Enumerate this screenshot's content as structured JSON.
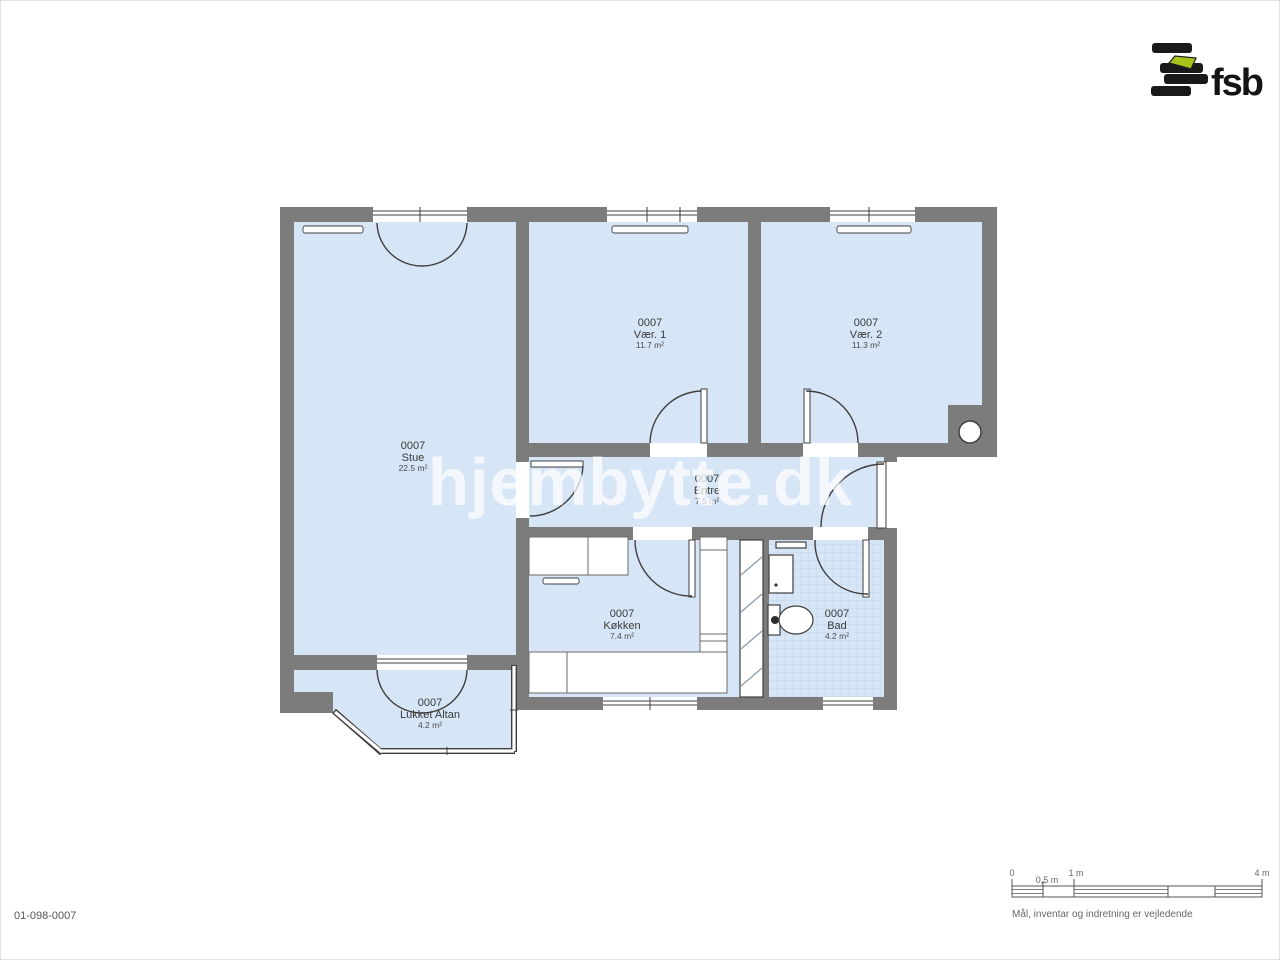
{
  "logo": {
    "brand": "fsb"
  },
  "watermark": {
    "text": "hjembytte.dk"
  },
  "drawing_number": "01-098-0007",
  "rooms": {
    "stue": {
      "id": "0007",
      "name": "Stue",
      "area": "22.5 m²"
    },
    "vaer1": {
      "id": "0007",
      "name": "Vær. 1",
      "area": "11.7 m²"
    },
    "vaer2": {
      "id": "0007",
      "name": "Vær. 2",
      "area": "11.3 m²"
    },
    "entre": {
      "id": "0007",
      "name": "Entre",
      "area": "7.5 m²"
    },
    "koekken": {
      "id": "0007",
      "name": "Køkken",
      "area": "7.4 m²"
    },
    "bad": {
      "id": "0007",
      "name": "Bad",
      "area": "4.2 m²"
    },
    "altan": {
      "id": "0007",
      "name": "Lukket Altan",
      "area": "4.2 m²"
    }
  },
  "scalebar": {
    "tick0": "0",
    "tick05": "0,5 m",
    "tick1": "1 m",
    "tick4": "4 m",
    "note": "Mål, inventar og indretning er vejledende"
  },
  "colors": {
    "wall": "#7c7c7c",
    "floor": "#d7e6f6",
    "tile_line": "#bcd2e8",
    "line": "#3f3f3f",
    "accent_green": "#a6c41a"
  }
}
